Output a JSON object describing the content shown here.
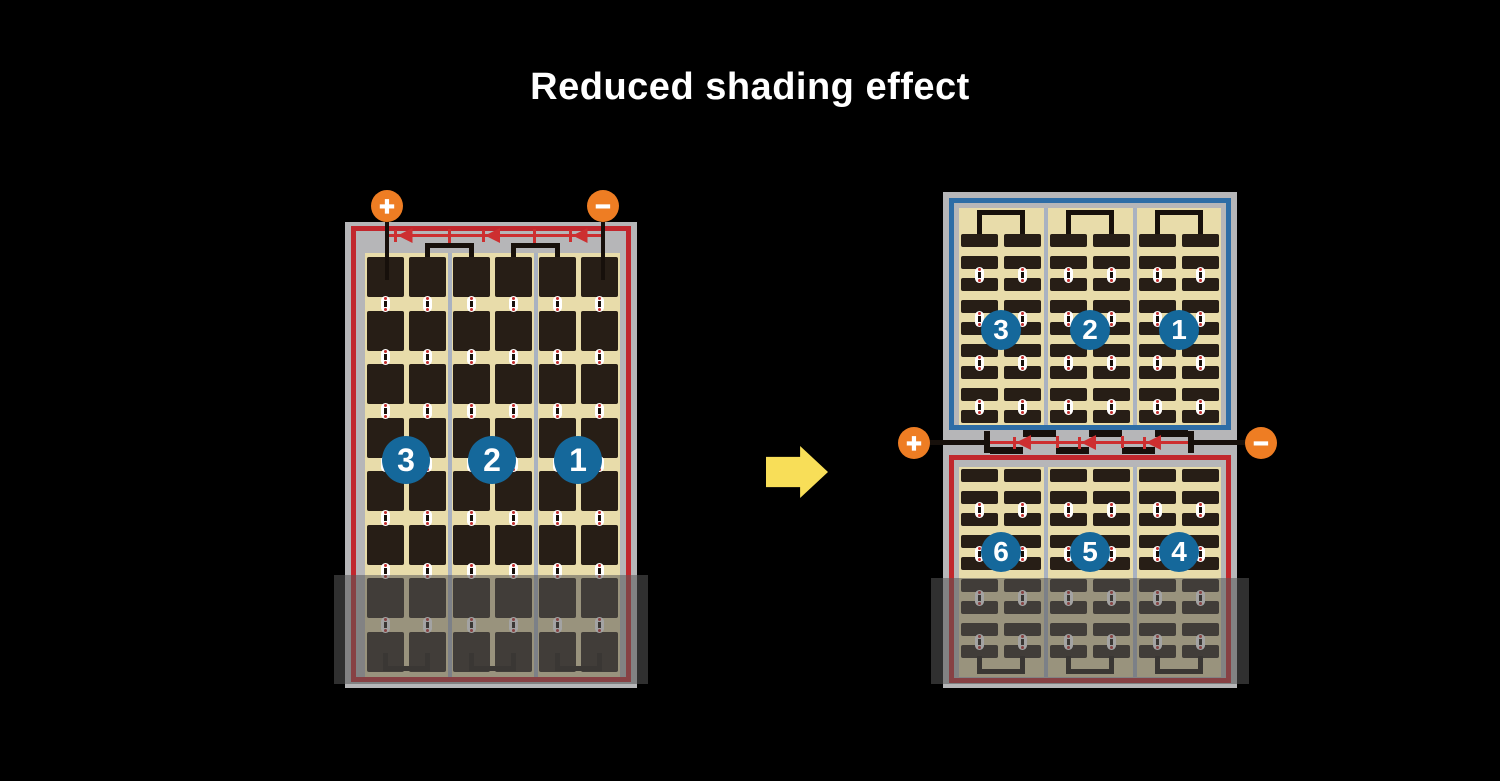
{
  "title": "Reduced shading effect",
  "left_module": {
    "positive_label": "+",
    "negative_label": "−",
    "strings": [
      "3",
      "2",
      "1"
    ]
  },
  "right_module": {
    "positive_label": "+",
    "negative_label": "−",
    "top_strings": [
      "3",
      "2",
      "1"
    ],
    "bottom_strings": [
      "6",
      "5",
      "4"
    ]
  },
  "colors": {
    "background": "#000000",
    "title_text": "#ffffff",
    "frame_gray": "#b6b6b8",
    "cell_area_tan": "#e8dcaa",
    "cell_dark": "#271e16",
    "border_red": "#c1272d",
    "border_blue": "#2d6da6",
    "wire_black": "#17100b",
    "diode_red": "#cd2f30",
    "divider_gray": "#a9b2c1",
    "badge_blue": "#15689b",
    "terminal_orange": "#ee7d23",
    "arrow_yellow": "#f8de58",
    "connector_white": "#ffffff",
    "connector_dot_red": "#c22c2c",
    "shade": "rgba(88,88,88,0.55)"
  }
}
